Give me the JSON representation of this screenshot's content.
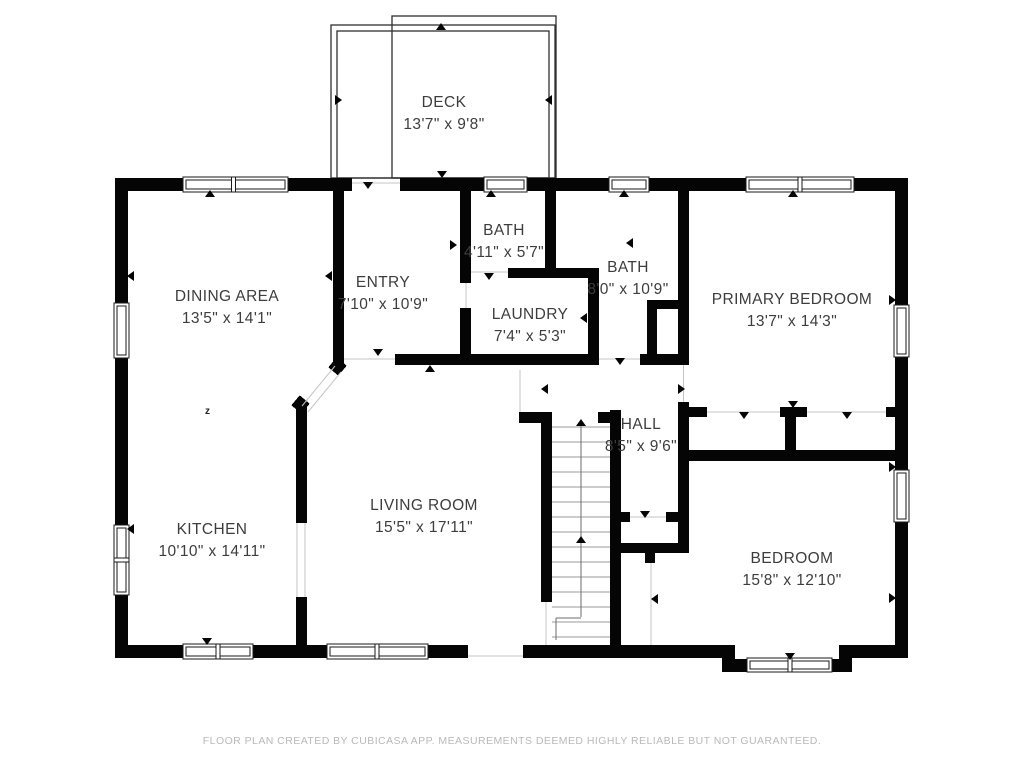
{
  "rooms": {
    "deck": {
      "label": "DECK",
      "dims": "13'7\" x 9'8\""
    },
    "bath_small": {
      "label": "BATH",
      "dims": "4'11\" x 5'7\""
    },
    "bath_main": {
      "label": "BATH",
      "dims": "8'0\" x 10'9\""
    },
    "entry": {
      "label": "ENTRY",
      "dims": "7'10\" x 10'9\""
    },
    "dining": {
      "label": "DINING AREA",
      "dims": "13'5\" x 14'1\""
    },
    "laundry": {
      "label": "LAUNDRY",
      "dims": "7'4\" x 5'3\""
    },
    "primary_bedroom": {
      "label": "PRIMARY BEDROOM",
      "dims": "13'7\" x 14'3\""
    },
    "hall": {
      "label": "HALL",
      "dims": "8'5\" x 9'6\""
    },
    "kitchen": {
      "label": "KITCHEN",
      "dims": "10'10\" x 14'11\""
    },
    "living": {
      "label": "LIVING ROOM",
      "dims": "15'5\" x 17'11\""
    },
    "bedroom": {
      "label": "BEDROOM",
      "dims": "15'8\" x 12'10\""
    }
  },
  "footer": {
    "disclaimer": "FLOOR PLAN CREATED BY CUBICASA APP. MEASUREMENTS DEEMED HIGHLY RELIABLE BUT NOT GUARANTEED."
  },
  "colors": {
    "wall": "#050505",
    "label_text": "#3d3d3d",
    "footer_text": "#b9b9b9",
    "background": "#ffffff"
  }
}
